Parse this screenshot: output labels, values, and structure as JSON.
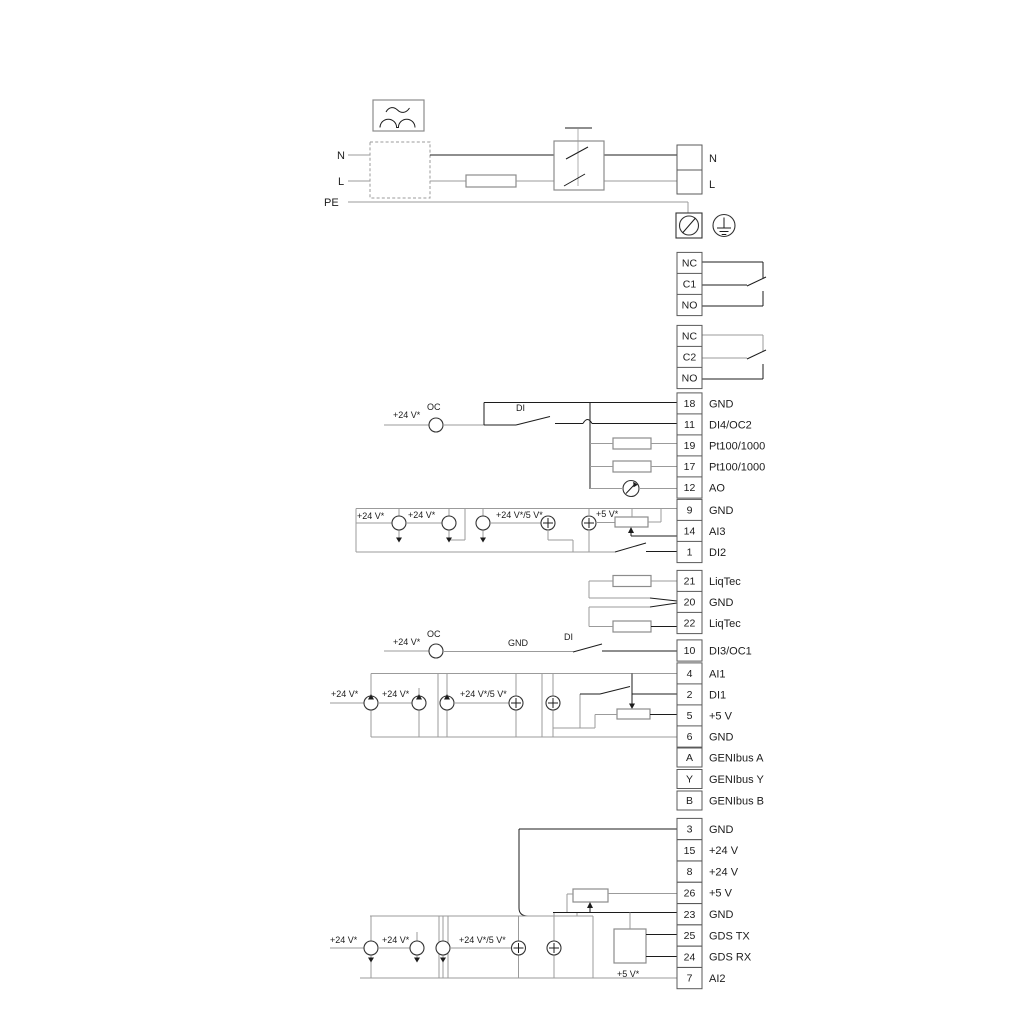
{
  "diagram_title": "drive-wiring-terminal-diagram",
  "colors": {
    "wire_gray": "#9b9b9b",
    "wire_dark": "#1c1c1c",
    "box_border": "#5a5a5a",
    "component_border": "#8c8c8c",
    "background": "#ffffff"
  },
  "labels": {
    "p24": "+24 V*",
    "p24_5": "+24 V*/5 V*",
    "p5": "+5 V*",
    "oc": "OC",
    "di": "DI",
    "gnd": "GND",
    "n": "N",
    "l": "L",
    "pe": "PE"
  },
  "relays": [
    {
      "top": "NC",
      "mid": "C1",
      "bottom": "NO"
    },
    {
      "top": "NC",
      "mid": "C2",
      "bottom": "NO"
    }
  ],
  "terminals": [
    {
      "id": "18",
      "label": "GND"
    },
    {
      "id": "11",
      "label": "DI4/OC2"
    },
    {
      "id": "19",
      "label": "Pt100/1000"
    },
    {
      "id": "17",
      "label": "Pt100/1000"
    },
    {
      "id": "12",
      "label": "AO"
    },
    {
      "id": "9",
      "label": "GND"
    },
    {
      "id": "14",
      "label": "AI3"
    },
    {
      "id": "1",
      "label": "DI2"
    },
    {
      "id": "21",
      "label": "LiqTec"
    },
    {
      "id": "20",
      "label": "GND"
    },
    {
      "id": "22",
      "label": "LiqTec"
    },
    {
      "id": "10",
      "label": "DI3/OC1"
    },
    {
      "id": "4",
      "label": "AI1"
    },
    {
      "id": "2",
      "label": "DI1"
    },
    {
      "id": "5",
      "label": "+5 V"
    },
    {
      "id": "6",
      "label": "GND"
    },
    {
      "id": "A",
      "label": "GENIbus A"
    },
    {
      "id": "Y",
      "label": "GENIbus Y"
    },
    {
      "id": "B",
      "label": "GENIbus B"
    },
    {
      "id": "3",
      "label": "GND"
    },
    {
      "id": "15",
      "label": "+24 V"
    },
    {
      "id": "8",
      "label": "+24 V"
    },
    {
      "id": "26",
      "label": "+5 V"
    },
    {
      "id": "23",
      "label": "GND"
    },
    {
      "id": "25",
      "label": "GDS TX"
    },
    {
      "id": "24",
      "label": "GDS RX"
    },
    {
      "id": "7",
      "label": "AI2"
    }
  ]
}
